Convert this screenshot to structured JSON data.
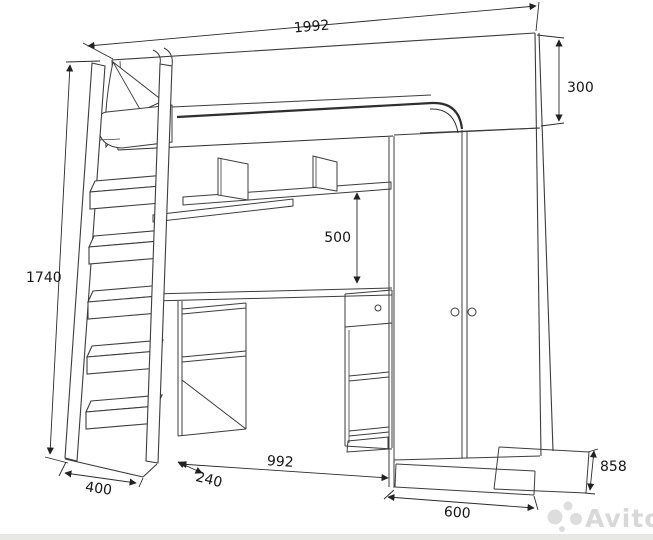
{
  "drawing": {
    "watermark_text": "Avito",
    "dims": {
      "top_width": "1992",
      "headboard_height": "300",
      "overall_height": "1740",
      "shelf_to_desk": "500",
      "desk_width": "992",
      "ladder_base_depth": "240",
      "ladder_base_width": "400",
      "wardrobe_width": "600",
      "unit_depth": "858"
    }
  }
}
